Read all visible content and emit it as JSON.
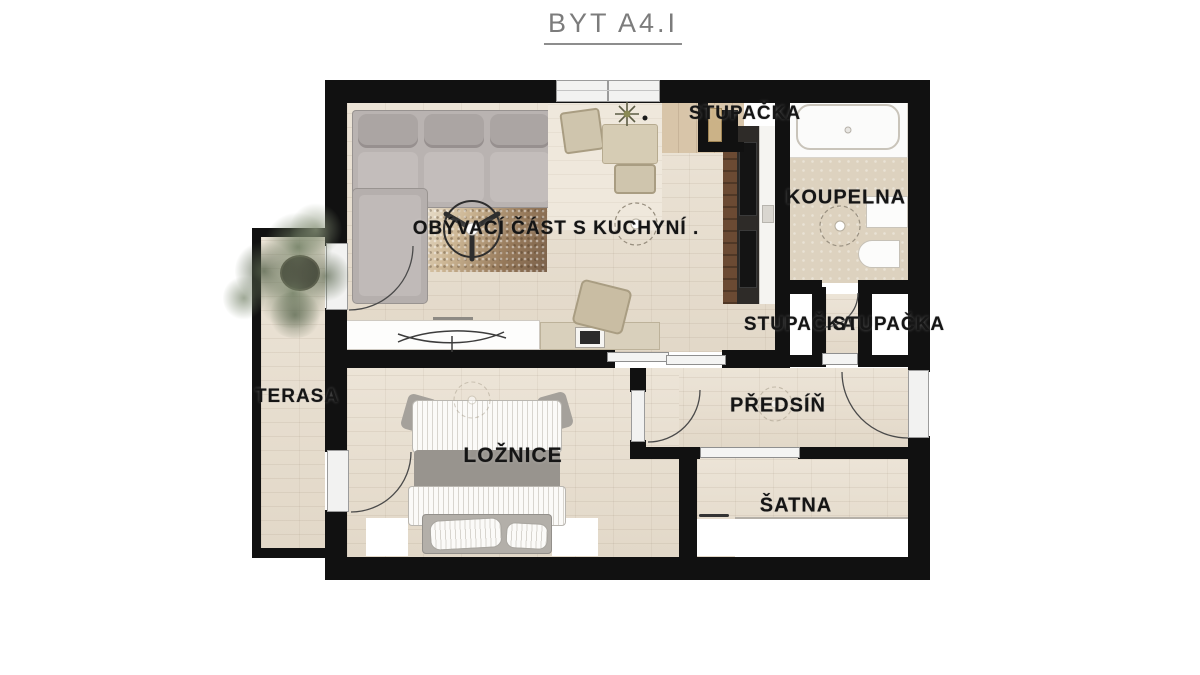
{
  "header": {
    "title": "BYT A4.I"
  },
  "rooms": {
    "living": {
      "label": "OBÝVACÍ ČÁST S KUCHYNÍ ."
    },
    "bathroom": {
      "label": "KOUPELNA"
    },
    "riser_top": {
      "label": "STUPAČKA"
    },
    "riser_left": {
      "label": "STUPAČKA"
    },
    "riser_right": {
      "label": "STUPAČKA"
    },
    "hall": {
      "label": "PŘEDSÍŇ"
    },
    "closet": {
      "label": "ŠATNA"
    },
    "bedroom": {
      "label": "LOŽNICE"
    },
    "terrace": {
      "label": "TERASA"
    }
  },
  "symbols": {
    "ceiling_fan": "circle-with-three-blades",
    "ceiling_light": "dashed-circle-with-dot",
    "door_swing": "quarter-arc"
  },
  "colors": {
    "wall": "#111111",
    "wood_floor": "#e8dfd2",
    "kitchen_wood": "#d8c5a9",
    "bathroom_floor": "#ddd2bf",
    "sofa_gray": "#b7b1af",
    "bed_gray": "#9c9892",
    "rug_brown": "#8a6f52",
    "cabinet_brown": "#5f4533",
    "appliance_black": "#1f1d1b",
    "furniture_beige": "#cfc5ad",
    "plant_green": "#6e7a60",
    "title_gray": "#7c7c7c",
    "label_color": "#151515"
  }
}
